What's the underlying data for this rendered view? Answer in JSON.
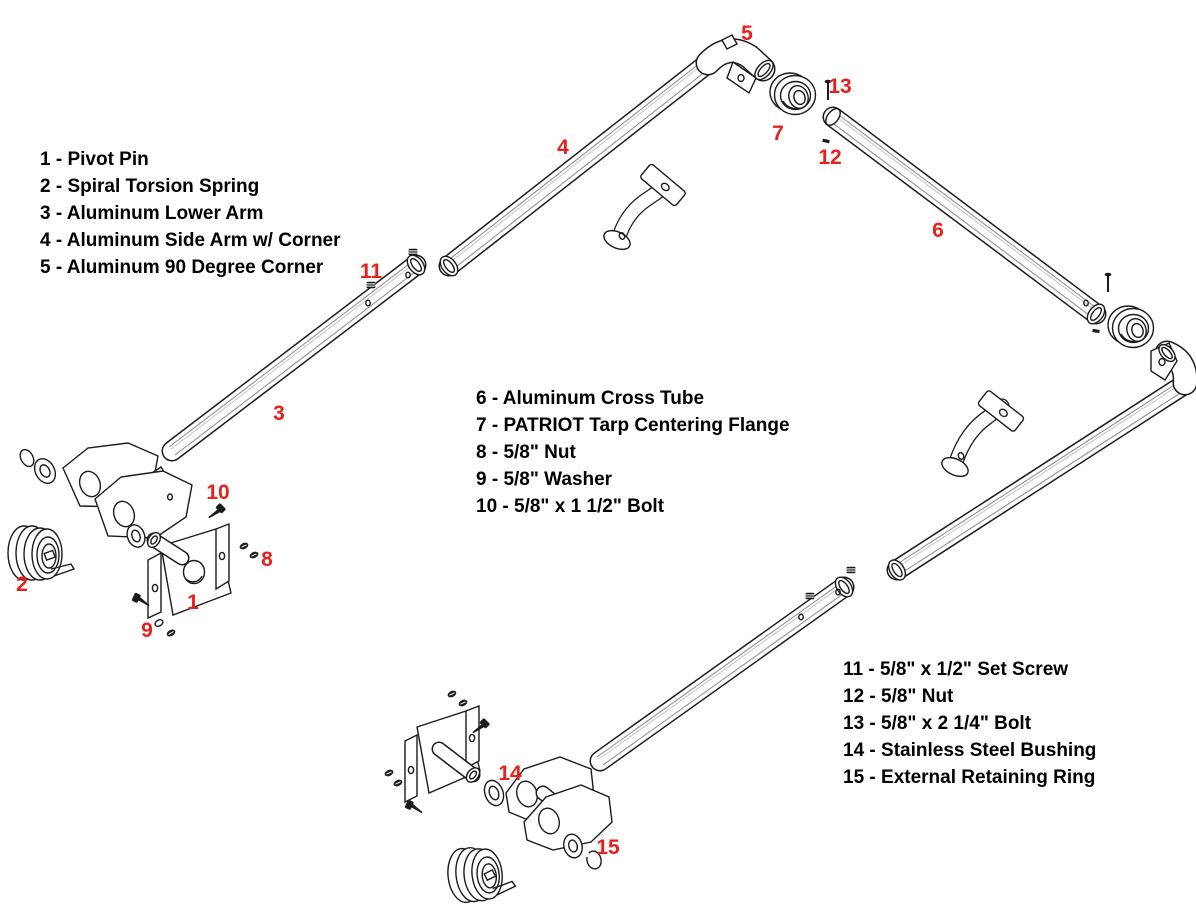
{
  "colors": {
    "background": "#ffffff",
    "line_art": "#1b1b1b",
    "callout_red": "#e8201c",
    "legend_text": "#000000"
  },
  "legend_blocks": [
    {
      "id": "parts-1-5",
      "x": 40,
      "y": 146,
      "items": [
        "1 - Pivot Pin",
        "2 - Spiral Torsion Spring",
        "3 - Aluminum Lower Arm",
        "4 - Aluminum Side Arm w/ Corner",
        "5 - Aluminum 90 Degree Corner"
      ]
    },
    {
      "id": "parts-6-10",
      "x": 476,
      "y": 385,
      "items": [
        "6 - Aluminum Cross Tube",
        "7 - PATRIOT Tarp Centering Flange",
        "8 - 5/8\" Nut",
        "9 - 5/8\" Washer",
        "10 - 5/8\" x 1 1/2\" Bolt"
      ]
    },
    {
      "id": "parts-11-15",
      "x": 843,
      "y": 656,
      "items": [
        "11 - 5/8\" x 1/2\" Set Screw",
        "12 - 5/8\" Nut",
        "13 - 5/8\" x 2 1/4\" Bolt",
        "14 - Stainless Steel Bushing",
        "15 - External Retaining Ring"
      ]
    }
  ],
  "callouts": [
    {
      "num": "1",
      "x": 193,
      "y": 603
    },
    {
      "num": "2",
      "x": 22,
      "y": 585
    },
    {
      "num": "3",
      "x": 279,
      "y": 414
    },
    {
      "num": "4",
      "x": 563,
      "y": 148
    },
    {
      "num": "5",
      "x": 747,
      "y": 34
    },
    {
      "num": "6",
      "x": 938,
      "y": 231
    },
    {
      "num": "7",
      "x": 778,
      "y": 134
    },
    {
      "num": "8",
      "x": 267,
      "y": 560
    },
    {
      "num": "9",
      "x": 147,
      "y": 631
    },
    {
      "num": "10",
      "x": 218,
      "y": 493
    },
    {
      "num": "11",
      "x": 371,
      "y": 272
    },
    {
      "num": "12",
      "x": 830,
      "y": 158
    },
    {
      "num": "13",
      "x": 840,
      "y": 87
    },
    {
      "num": "14",
      "x": 510,
      "y": 774
    },
    {
      "num": "15",
      "x": 608,
      "y": 848
    }
  ]
}
